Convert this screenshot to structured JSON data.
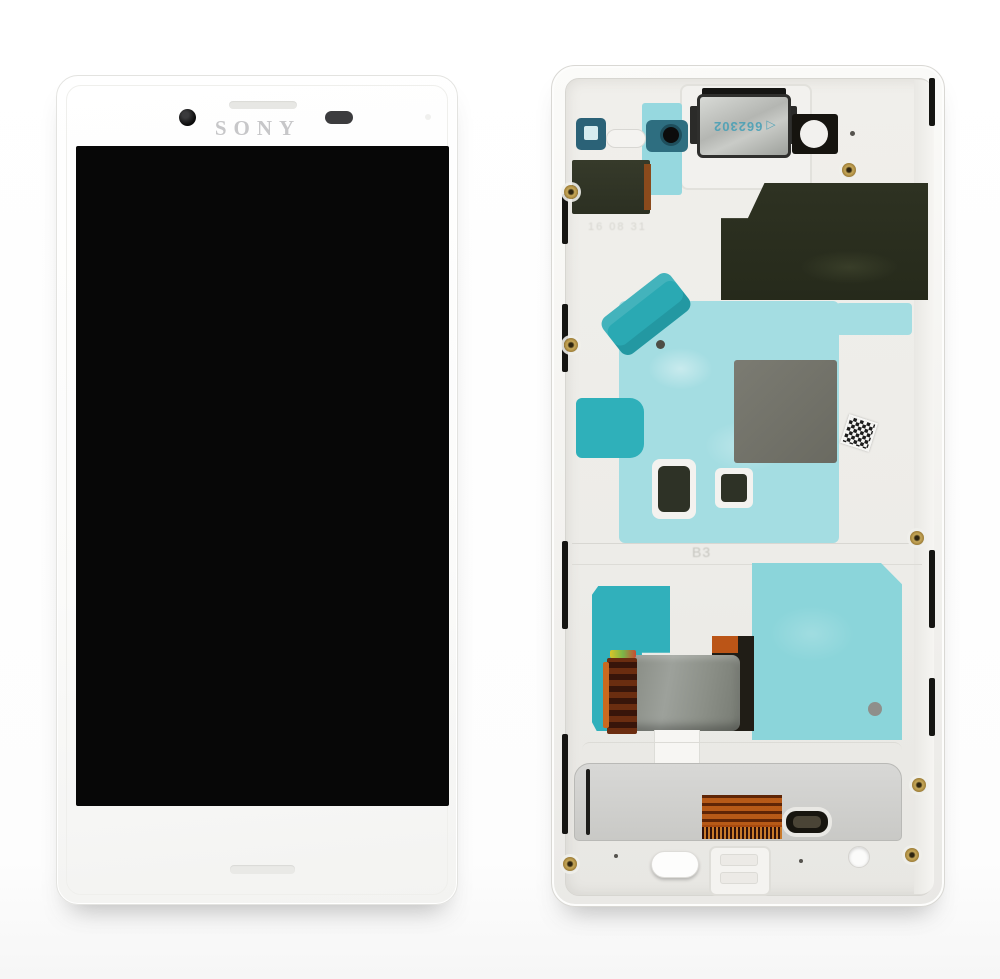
{
  "product": {
    "brand": "SONY",
    "speaker_module_marking": "662302",
    "frame_marking": "B3",
    "molded_marking": "16 08 31"
  },
  "icons": {
    "direction_arrow": "◁"
  },
  "colors": {
    "background": "#ffffff",
    "frame_white": "#f6f5f3",
    "screen_black": "#070707",
    "adhesive_light_teal": "#a4dde2",
    "adhesive_dark_teal": "#2fb0ba",
    "adhesive_bottom_teal": "#8bd5da",
    "component_olive": "#2e3222",
    "gray_shield": "#72726a",
    "flex_copper": "#a8490e",
    "plate_silver": "#cdcdcb",
    "screw_brass": "#b3954a",
    "marking_blue": "#4aa0b6",
    "logo_gray": "#c7c7c9"
  }
}
